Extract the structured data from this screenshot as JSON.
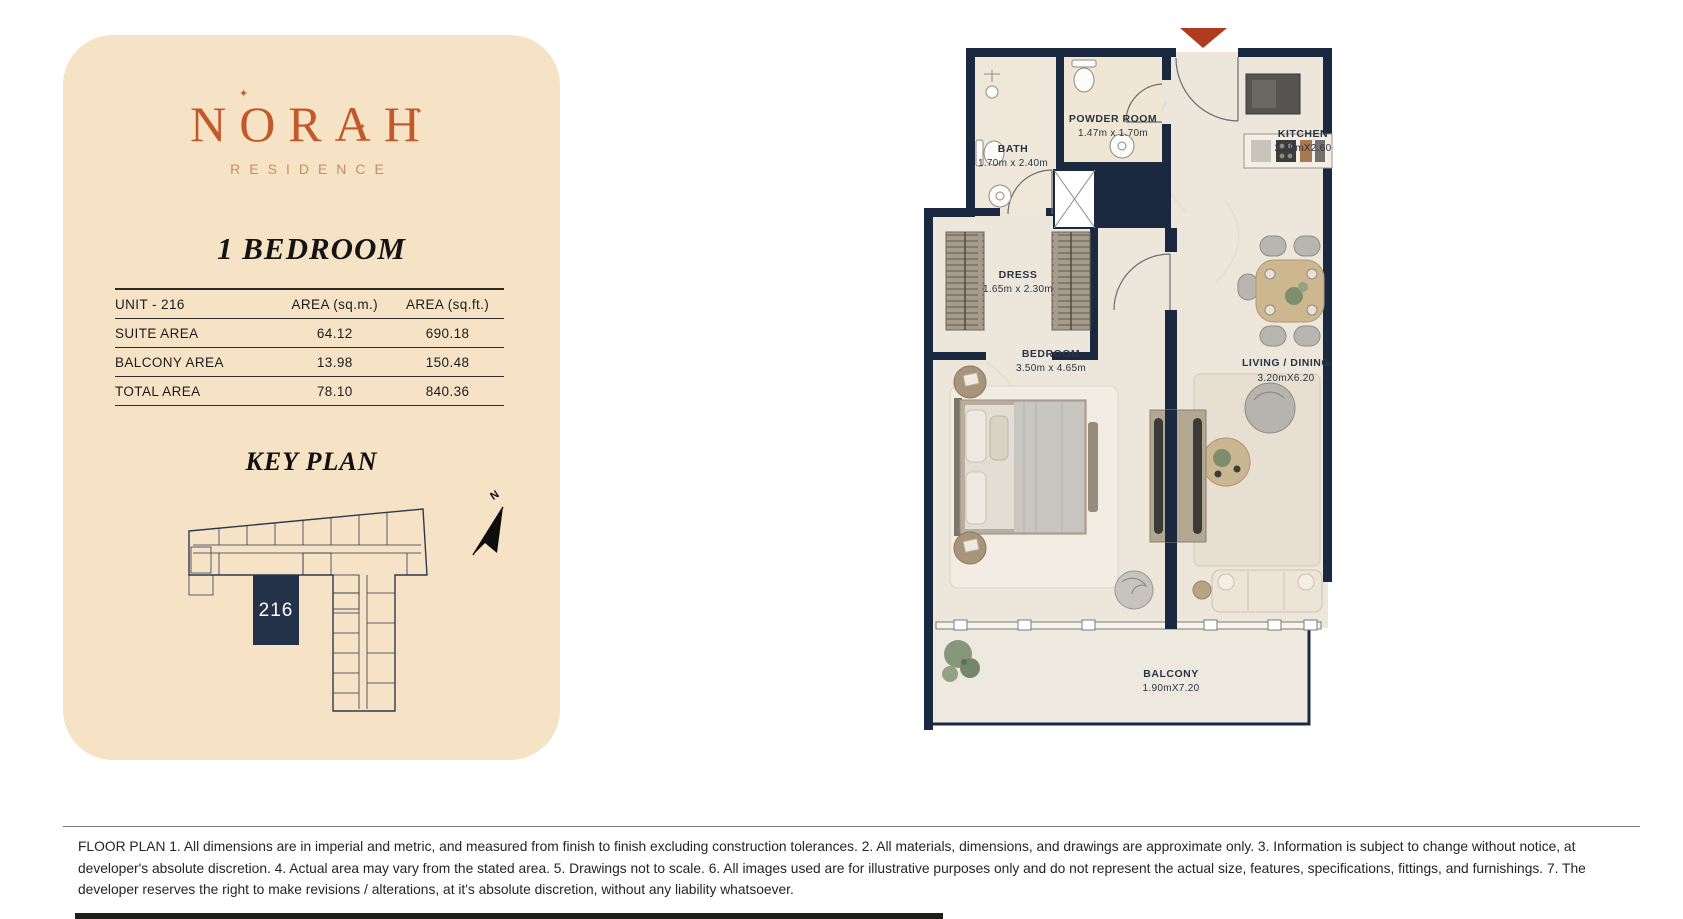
{
  "brand": {
    "name": "NORAH",
    "tagline": "RESIDENCE",
    "sparkle": "✦"
  },
  "unit": {
    "title": "1 BEDROOM"
  },
  "area_table": {
    "headers": [
      "UNIT - 216",
      "AREA (sq.m.)",
      "AREA (sq.ft.)"
    ],
    "rows": [
      [
        "SUITE AREA",
        "64.12",
        "690.18"
      ],
      [
        "BALCONY AREA",
        "13.98",
        "150.48"
      ],
      [
        "TOTAL AREA",
        "78.10",
        "840.36"
      ]
    ]
  },
  "key_plan": {
    "title": "KEY PLAN",
    "unit_number": "216",
    "north_label": "N"
  },
  "floor_plan": {
    "rooms": [
      {
        "name": "BATH",
        "dims": "1.70m x 2.40m"
      },
      {
        "name": "POWDER ROOM",
        "dims": "1.47m x 1.70m"
      },
      {
        "name": "KITCHEN",
        "dims": "2.30mX2.60"
      },
      {
        "name": "DRESS",
        "dims": "1.65m x 2.30m"
      },
      {
        "name": "BEDROOM",
        "dims": "3.50m x 4.65m"
      },
      {
        "name": "LIVING / DINING",
        "dims": "3.20mX6.20"
      },
      {
        "name": "BALCONY",
        "dims": "1.90mX7.20"
      }
    ]
  },
  "colors": {
    "brand_orange": "#c2592b",
    "residence_tan": "#c78f5c",
    "panel_cream": "#f6e3c6",
    "wall_navy": "#1b2940",
    "entry_marker_red": "#b23a1e",
    "floor": "#ece6db"
  },
  "disclaimer": {
    "text": "FLOOR PLAN 1. All dimensions are in imperial and metric, and measured from finish to finish excluding construction tolerances. 2. All materials, dimensions, and drawings are approximate only. 3. Information is subject to change without notice, at developer's absolute discretion. 4. Actual area may vary from the stated area. 5. Drawings not to scale. 6. All images used are for illustrative purposes only and do not represent the actual size, features, specifications, fittings, and furnishings. 7. The developer reserves the right to make revisions / alterations, at it's absolute discretion, without any liability whatsoever."
  }
}
